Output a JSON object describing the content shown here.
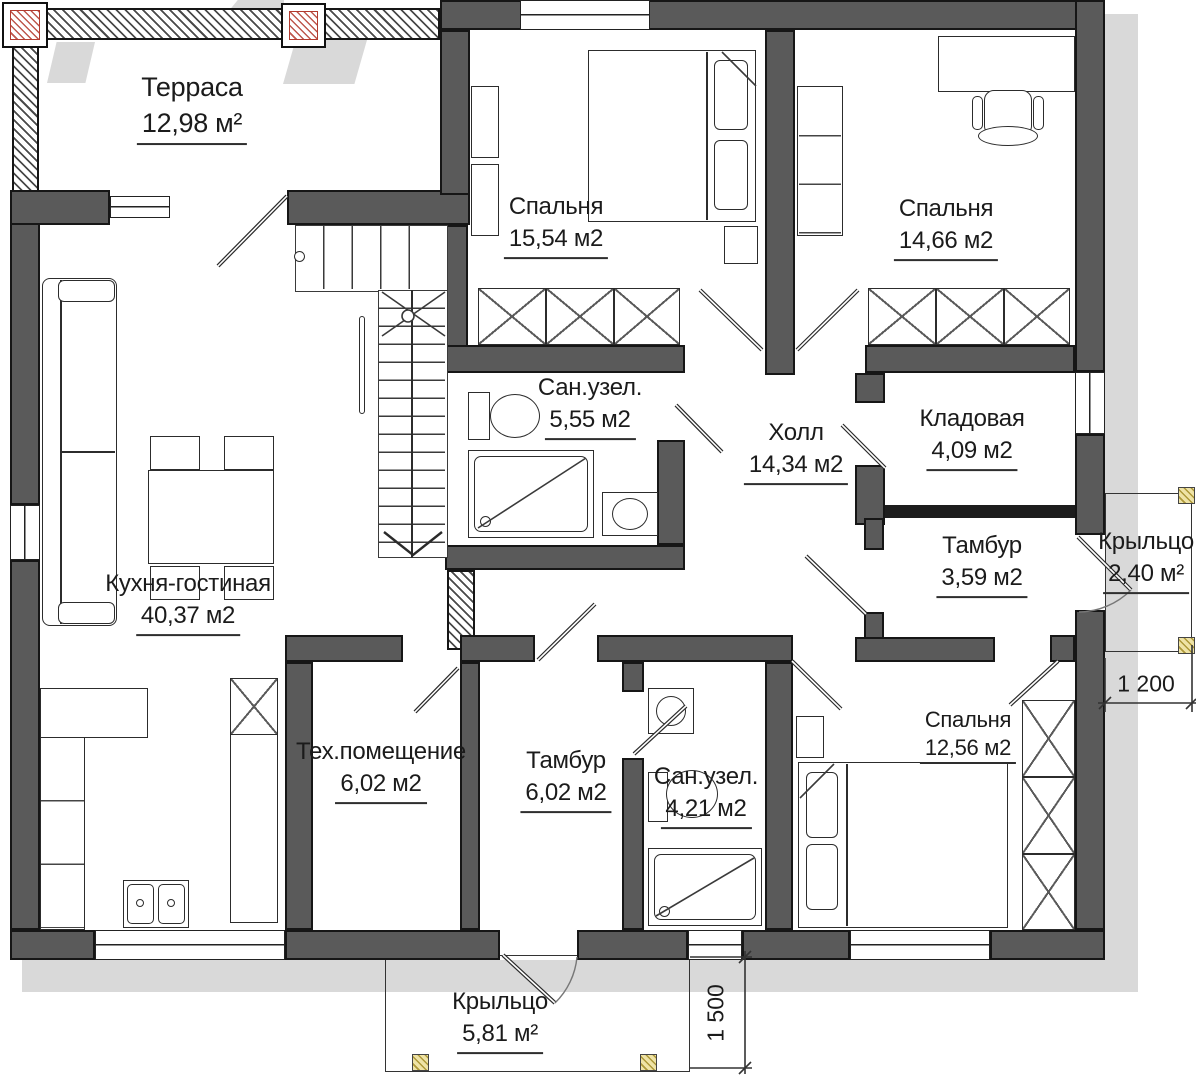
{
  "plan_title": "Поэтажный план одноэтажного дома",
  "rooms": {
    "terrace": {
      "name": "Терраса",
      "area": "12,98 м²"
    },
    "bedroom1": {
      "name": "Спальня",
      "area": "15,54 м2"
    },
    "bedroom2": {
      "name": "Спальня",
      "area": "14,66 м2"
    },
    "bathroom1": {
      "name": "Сан.узел.",
      "area": "5,55 м2"
    },
    "hall": {
      "name": "Холл",
      "area": "14,34 м2"
    },
    "storage": {
      "name": "Кладовая",
      "area": "4,09 м2"
    },
    "vestibule1": {
      "name": "Тамбур",
      "area": "3,59 м2"
    },
    "porch_right": {
      "name": "Крыльцо",
      "area": "2,40 м²"
    },
    "kitchen_living": {
      "name": "Кухня-гостиная",
      "area": "40,37 м2"
    },
    "tech_room": {
      "name": "Тех.помещение",
      "area": "6,02 м2"
    },
    "vestibule2": {
      "name": "Тамбур",
      "area": "6,02 м2"
    },
    "bathroom2": {
      "name": "Сан.узел.",
      "area": "4,21 м2"
    },
    "bedroom3": {
      "name": "Спальня",
      "area": "12,56 м2"
    },
    "porch_bottom": {
      "name": "Крыльцо",
      "area": "5,81 м²"
    }
  },
  "dimensions": {
    "porch_right_width": "1 200",
    "porch_bottom_depth": "1 500"
  },
  "colors": {
    "wall_fill": "#5a5a5a",
    "outline": "#161616",
    "shadow": "#d9d9d9",
    "column_hatch_red": "#b23a2e",
    "column_hatch_yellow": "#ad9838"
  }
}
